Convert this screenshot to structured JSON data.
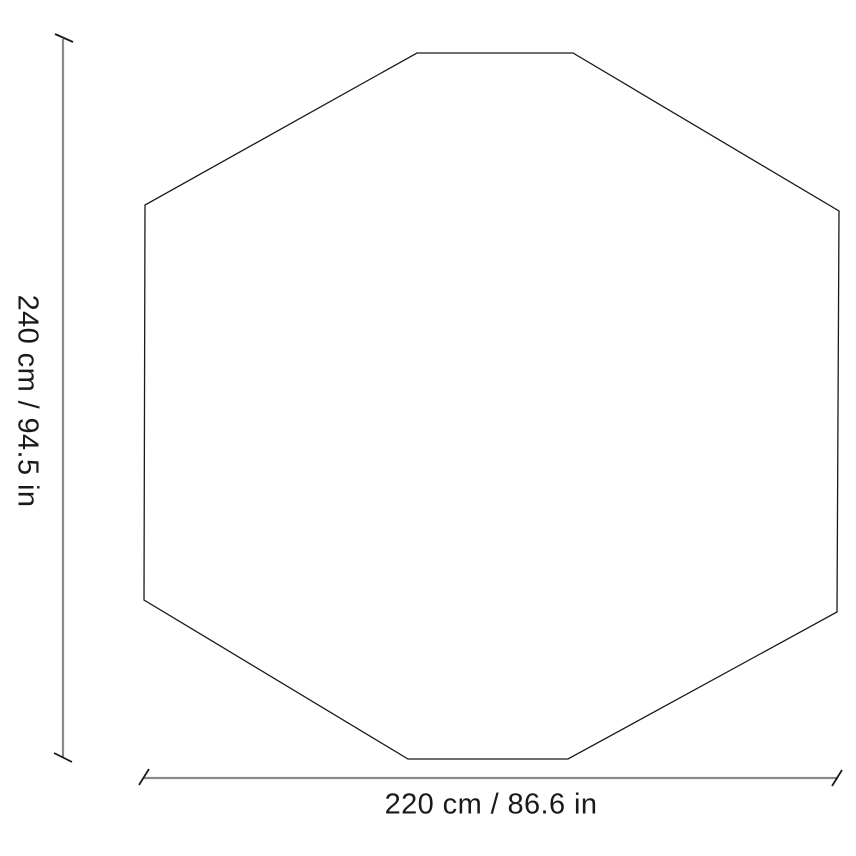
{
  "diagram": {
    "shape": "octagon",
    "height_dimension": {
      "label": "240 cm / 94.5 in",
      "value_cm": 240,
      "value_in": 94.5
    },
    "width_dimension": {
      "label": "220 cm / 86.6 in",
      "value_cm": 220,
      "value_in": 86.6
    },
    "colors": {
      "outline": "#1a1a1a",
      "dimension_line": "#8a8a8a",
      "tick": "#1a1a1a",
      "text": "#1a1a1a",
      "background": "#ffffff"
    }
  }
}
